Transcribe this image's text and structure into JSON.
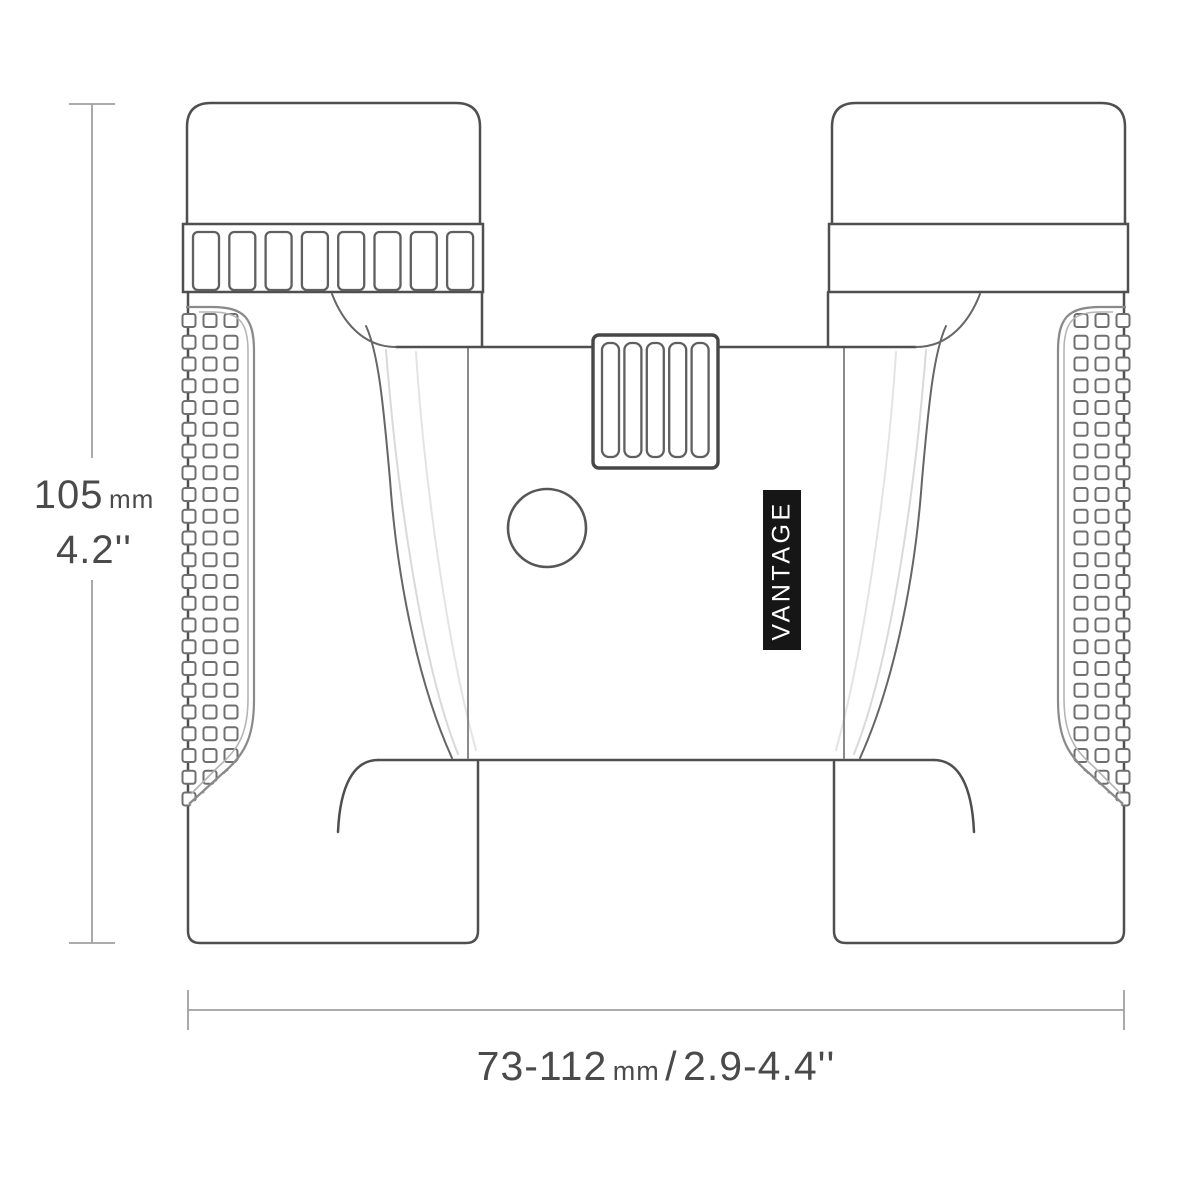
{
  "diagram": {
    "subject": "binoculars-top-view-line-drawing",
    "brand_label": "VANTAGE",
    "dimensions": {
      "height": {
        "value": "105",
        "unit": "mm",
        "inches": "4.2''"
      },
      "width": {
        "range": "73-112",
        "unit": "mm",
        "separator": "/",
        "inches": "2.9-4.4''"
      }
    },
    "colors": {
      "bg": "#ffffff",
      "line": "#4f4f4f",
      "line_soft": "#8a8a8a",
      "faint": "#d9d9d9",
      "faint2": "#e4e4e4",
      "grip": "#6f6f6f",
      "dim": "#a0a0a0",
      "text": "#4a4a4a",
      "label_bg": "#161616",
      "label_text": "#ffffff"
    },
    "pattern": {
      "eyecup_slots": 8,
      "wheel_slots": 5,
      "grip_columns": 3,
      "grip_rows": 23
    }
  }
}
